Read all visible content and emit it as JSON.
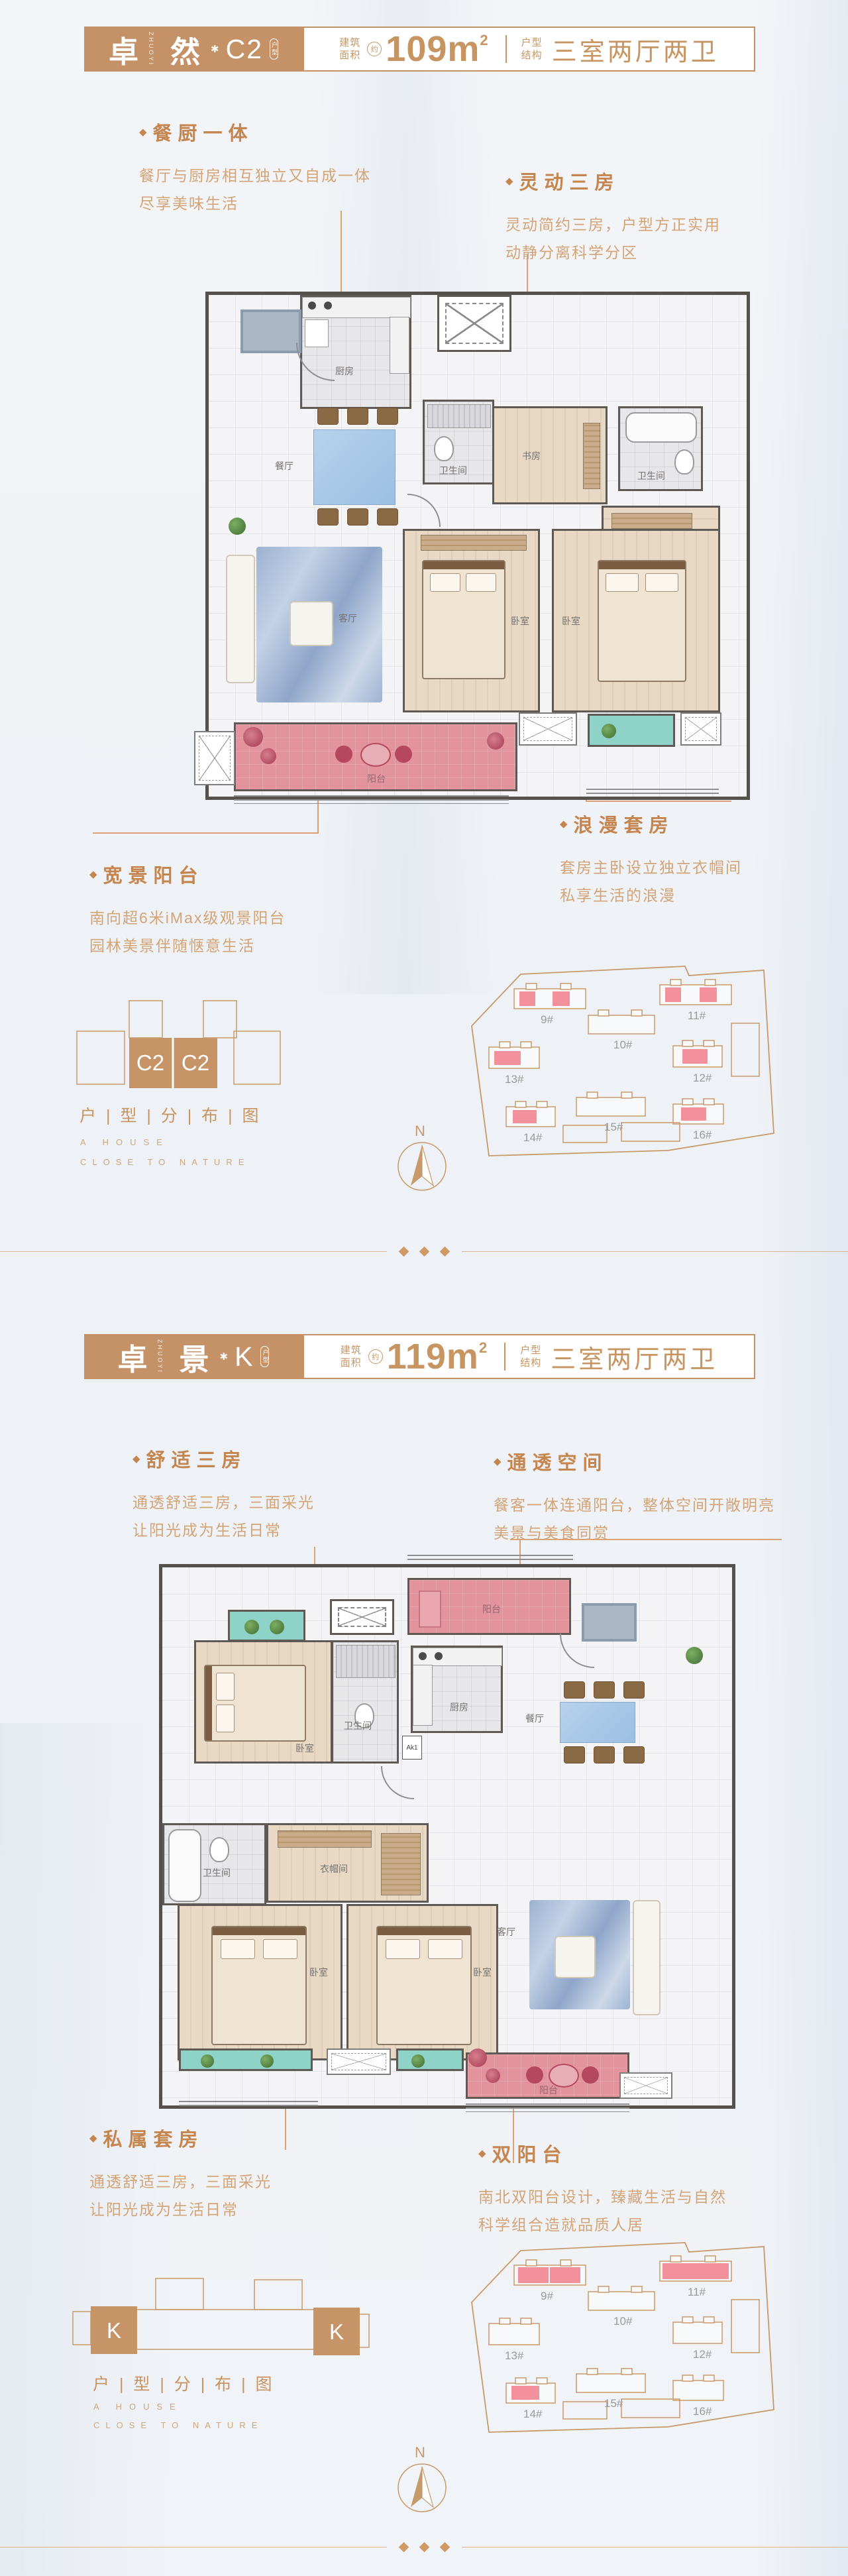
{
  "colors": {
    "accent_tan": "#c59267",
    "feature_title": "#c5854e",
    "feature_body": "#d2a476",
    "site_outline": "#c79a6b",
    "highlight_pink": "#f2909c",
    "balcony_pink": "#e2939c",
    "balcony_green": "#8fd2c7"
  },
  "icons": {
    "diamond": "◆",
    "star": "✱"
  },
  "s1": {
    "header": {
      "zh1": "卓",
      "vertical": "ZHUOYI",
      "zh2": "然",
      "code": "C2",
      "badge": "户型",
      "area_l1": "建筑",
      "area_l2": "面积",
      "approx": "约",
      "area": "109m",
      "sup": "2",
      "type_l1": "户型",
      "type_l2": "结构",
      "type_value": "三室两厅两卫"
    },
    "features": [
      {
        "title": "餐厨一体",
        "line1": "餐厅与厨房相互独立又自成一体",
        "line2": "尽享美味生活"
      },
      {
        "title": "灵动三房",
        "line1": "灵动简约三房，户型方正实用",
        "line2": "动静分离科学分区"
      },
      {
        "title": "宽景阳台",
        "line1": "南向超6米iMax级观景阳台",
        "line2": "园林美景伴随惬意生活"
      },
      {
        "title": "浪漫套房",
        "line1": "套房主卧设立独立衣帽间",
        "line2": "私享生活的浪漫"
      }
    ],
    "rooms": {
      "kitchen": "厨房",
      "bath1": "卫生间",
      "study": "书房",
      "bath2": "卫生间",
      "cloak": "衣帽间",
      "dining": "餐厅",
      "living": "客厅",
      "bed1": "卧室",
      "bed2": "卧室",
      "balcony": "阳台"
    },
    "dist": {
      "unit1": "C2",
      "unit2": "C2",
      "caption": "户 | 型 | 分 | 布 | 图",
      "en1": "A HOUSE",
      "en2": "CLOSE TO NATURE"
    },
    "site": {
      "labels": [
        "9#",
        "10#",
        "11#",
        "12#",
        "13#",
        "14#",
        "15#",
        "16#"
      ]
    },
    "compass": "N"
  },
  "s2": {
    "header": {
      "zh1": "卓",
      "vertical": "ZHUOYI",
      "zh2": "景",
      "code": "K",
      "badge": "户型",
      "area_l1": "建筑",
      "area_l2": "面积",
      "approx": "约",
      "area": "119m",
      "sup": "2",
      "type_l1": "户型",
      "type_l2": "结构",
      "type_value": "三室两厅两卫"
    },
    "features": [
      {
        "title": "舒适三房",
        "line1": "通透舒适三房，三面采光",
        "line2": "让阳光成为生活日常"
      },
      {
        "title": "通透空间",
        "line1": "餐客一体连通阳台，整体空间开敞明亮",
        "line2": "美景与美食同赏"
      },
      {
        "title": "私属套房",
        "line1": "通透舒适三房，三面采光",
        "line2": "让阳光成为生活日常"
      },
      {
        "title": "双阳台",
        "line1": "南北双阳台设计，臻藏生活与自然",
        "line2": "科学组合造就品质人居"
      }
    ],
    "rooms": {
      "balcony_n": "阳台",
      "bed1": "卧室",
      "bath1": "卫生间",
      "kitchen": "厨房",
      "dining": "餐厅",
      "bath2": "卫生间",
      "cloak": "衣帽间",
      "bed2": "卧室",
      "bed3": "卧室",
      "living": "客厅",
      "balcony_s": "阳台",
      "door_tag": "Ak1"
    },
    "dist": {
      "unit1": "K",
      "unit2": "K",
      "caption": "户 | 型 | 分 | 布 | 图",
      "en1": "A HOUSE",
      "en2": "CLOSE TO NATURE"
    },
    "site": {
      "labels": [
        "9#",
        "10#",
        "11#",
        "12#",
        "13#",
        "14#",
        "15#",
        "16#"
      ]
    },
    "compass": "N"
  }
}
